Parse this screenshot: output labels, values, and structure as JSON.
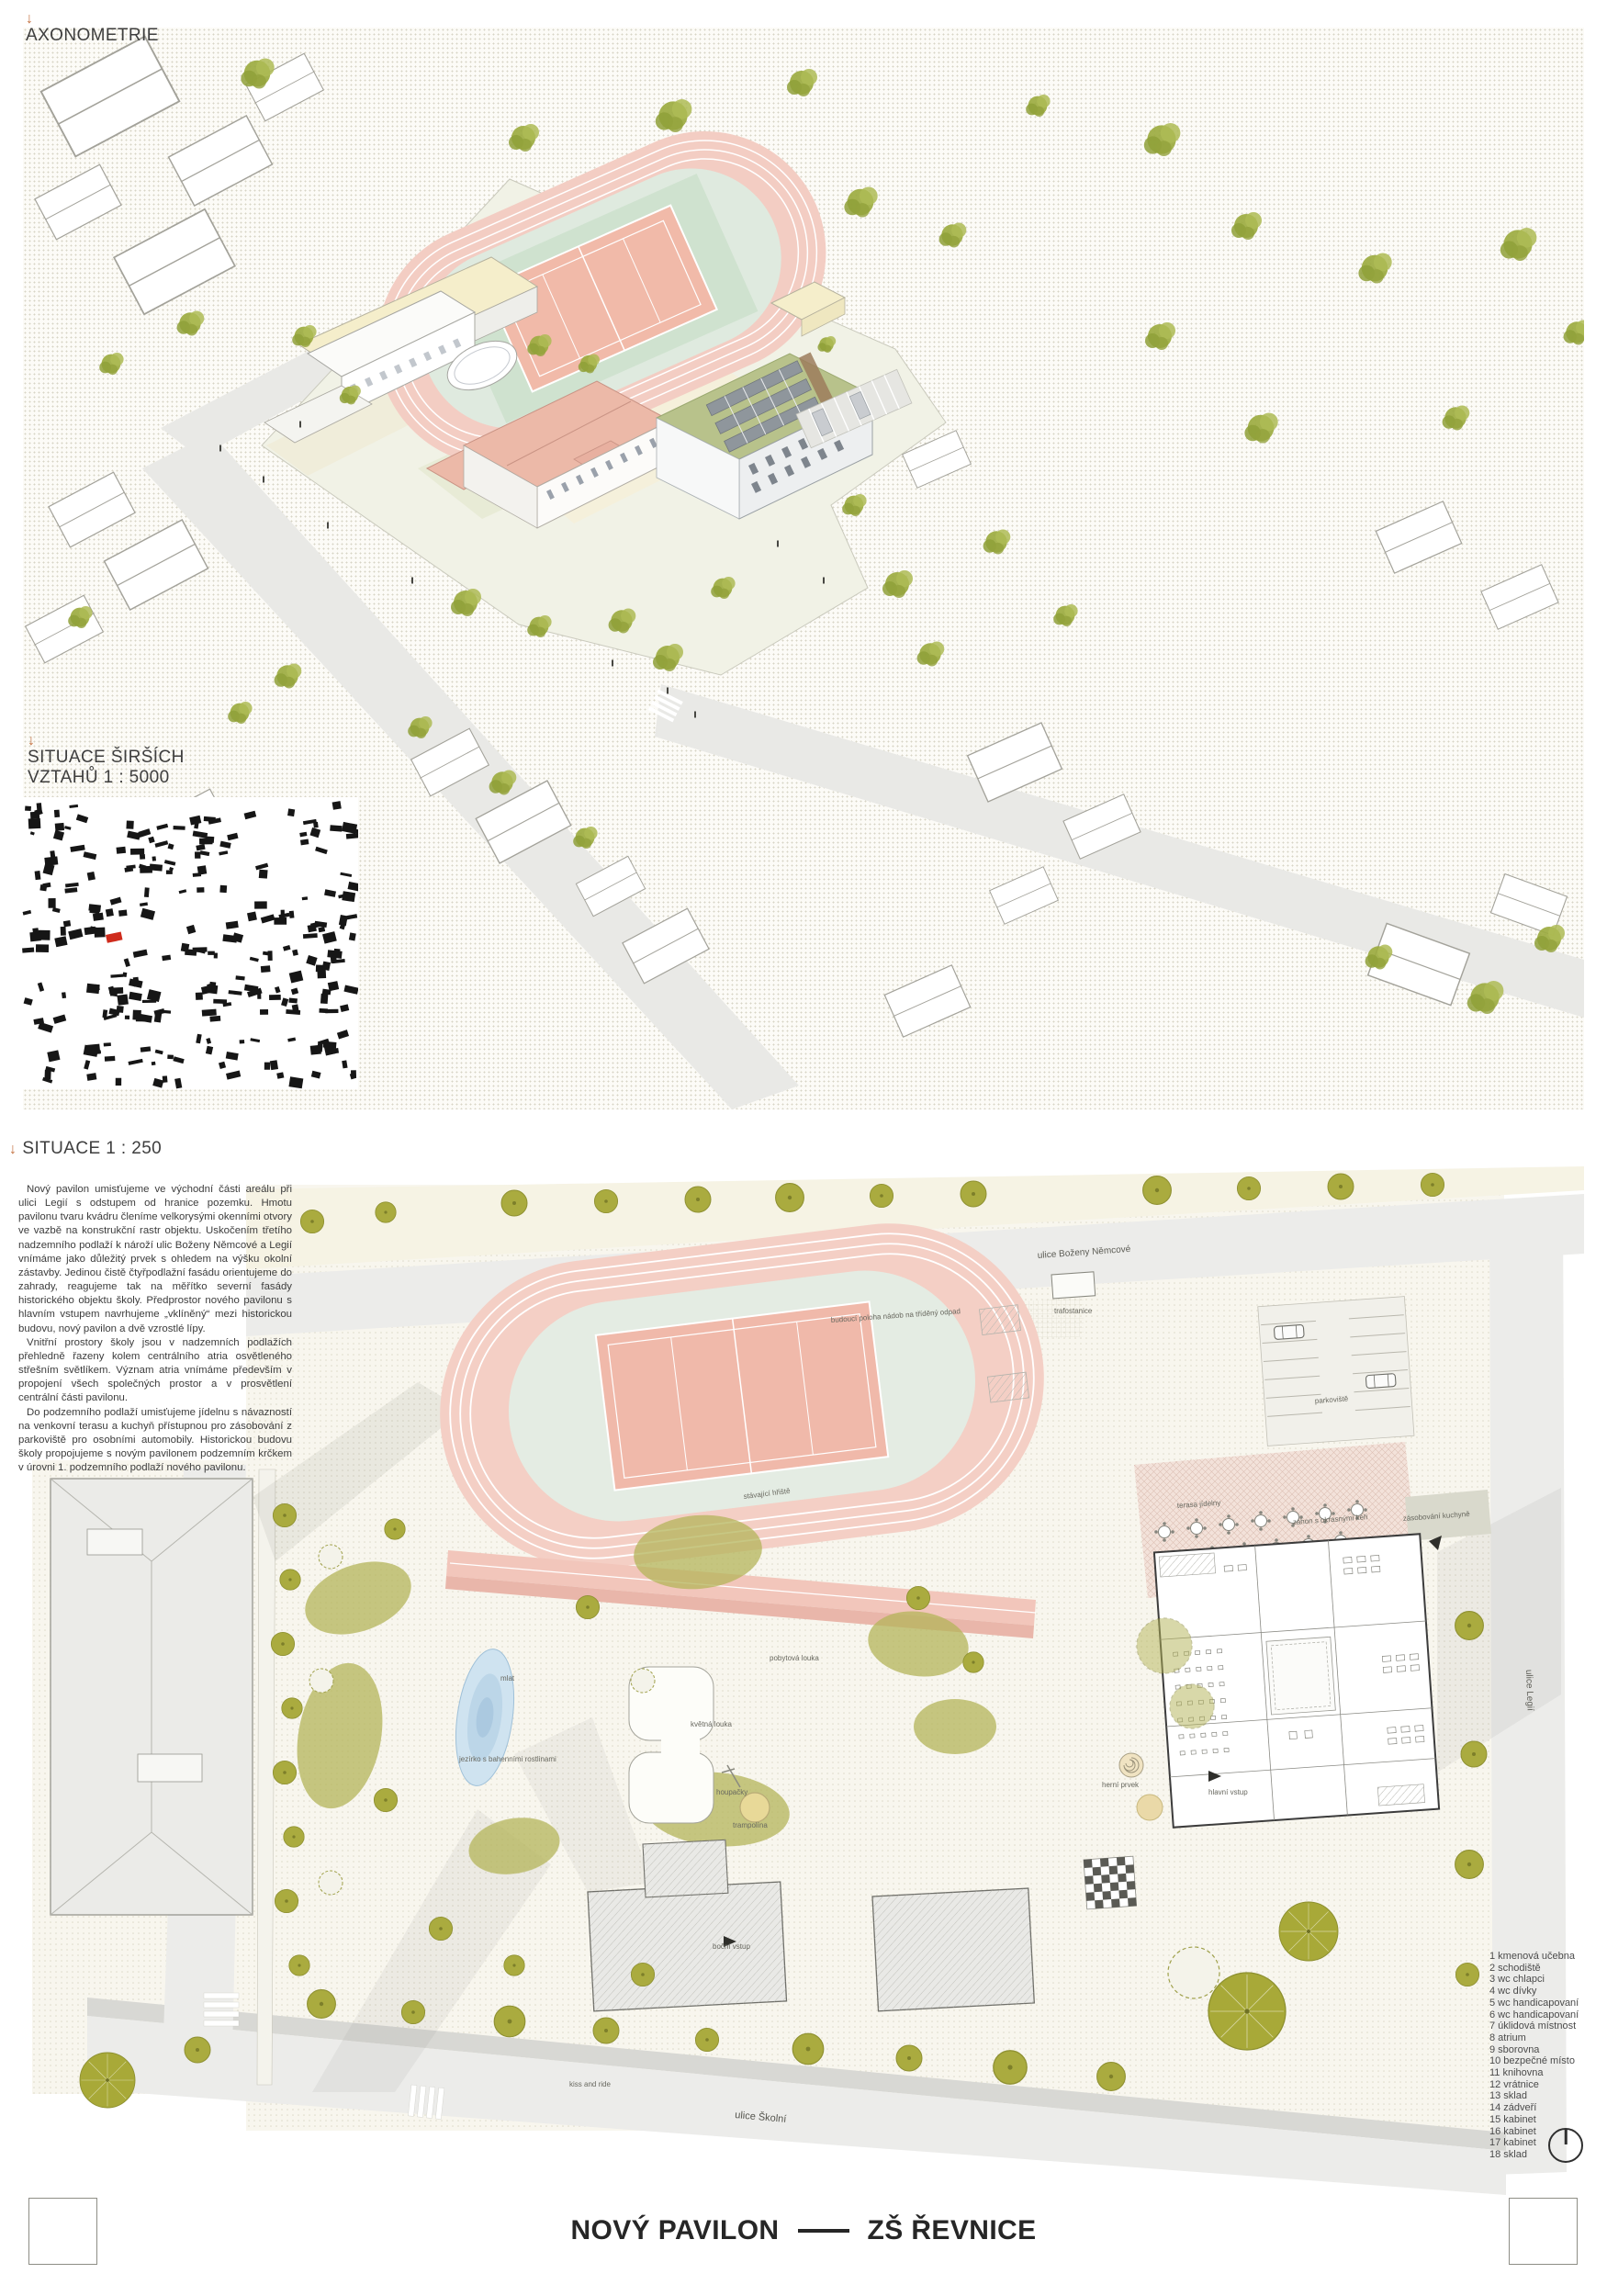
{
  "sections": {
    "axonometrie": {
      "arrow": "↓",
      "label": "AXONOMETRIE"
    },
    "situace_sirsich_vztahu": {
      "arrow": "↓",
      "line1": "SITUACE ŠIRŠÍCH",
      "line2": "VZTAHŮ   1 : 5000"
    },
    "situace": {
      "arrow": "↓",
      "label": "SITUACE   1 : 250"
    }
  },
  "description": {
    "p1": "Nový pavilon umisťujeme ve východní části areálu při ulici Legií s odstupem od hranice pozemku. Hmotu pavilonu tvaru kvádru členíme velkorysými okenními otvory ve vazbě na konstrukční rastr objektu. Uskočením třetího nadzemního podlaží k nároží ulic Boženy Němcové a Legií vnímáme jako důležitý prvek s ohledem na výšku okolní zástavby. Jedinou čistě čtyřpodlažní fasádu orientujeme do zahrady, reagujeme tak na měřítko severní fasády historického objektu školy. Předprostor nového pavilonu s hlavním vstupem navrhujeme „vklíněný“ mezi historickou budovu, nový pavilon a dvě vzrostlé lípy.",
    "p2": "Vnitřní prostory školy jsou v nadzemních podlažích přehledně řazeny kolem centrálního atria osvětleného střešním světlíkem. Význam atria vnímáme především v propojení všech společných prostor a v prosvětlení centrální části pavilonu.",
    "p3": "Do podzemního podlaží umisťujeme jídelnu s návazností na venkovní terasu a kuchyň přístupnou pro zásobování z parkoviště pro osobními automobily. Historickou budovu školy propojujeme s novým pavilonem podzemním krčkem v úrovni 1. podzemního podlaží nového pavilonu."
  },
  "plan_labels": {
    "street_top": "ulice Boženy Němcové",
    "street_right": "ulice Legií",
    "street_bottom": "ulice Školní",
    "waste_bins": "budoucí poloha nádob na tříděný odpad",
    "trafostanice": "trafostanice",
    "parking": "parkoviště",
    "existing_field": "stávající hřiště",
    "dwell_meadow": "pobytová louka",
    "mlat": "mlat",
    "pond": "jezírko s bahenními rostlinami",
    "flower_meadow": "květná louka",
    "swings": "houpačky",
    "trampoline": "trampolína",
    "dining_terrace": "terasa jídelny",
    "shrub_bed": "záhon s okrasnými keři",
    "kitchen_supply": "zásobování kuchyně",
    "play_element": "herní prvek",
    "main_entrance": "hlavní vstup",
    "side_entrance": "boční vstup",
    "kiss_and_ride": "kiss and ride"
  },
  "legend": {
    "items": [
      "1 kmenová učebna",
      "2 schodiště",
      "3 wc chlapci",
      "4 wc dívky",
      "5 wc handicapovaní",
      "6 wc handicapovaní",
      "7 úklidová místnost",
      "8 atrium",
      "9 sborovna",
      "10 bezpečné místo",
      "11 knihovna",
      "12 vrátnice",
      "13 sklad",
      "14 zádveří",
      "15 kabinet",
      "16 kabinet",
      "17 kabinet",
      "18 sklad"
    ]
  },
  "footer": {
    "title_left": "NOVÝ PAVILON",
    "title_right": "ZŠ ŘEVNICE"
  },
  "colors": {
    "accent_orange": "#c4713f",
    "track_pink": "#f4cfc5",
    "court_salmon": "#f0b9aa",
    "infield_green": "#e4ece3",
    "tree_olive": "#aaab3f",
    "roof_salmon": "#ecb9a8",
    "map_highlight_red": "#cf2b1c"
  }
}
